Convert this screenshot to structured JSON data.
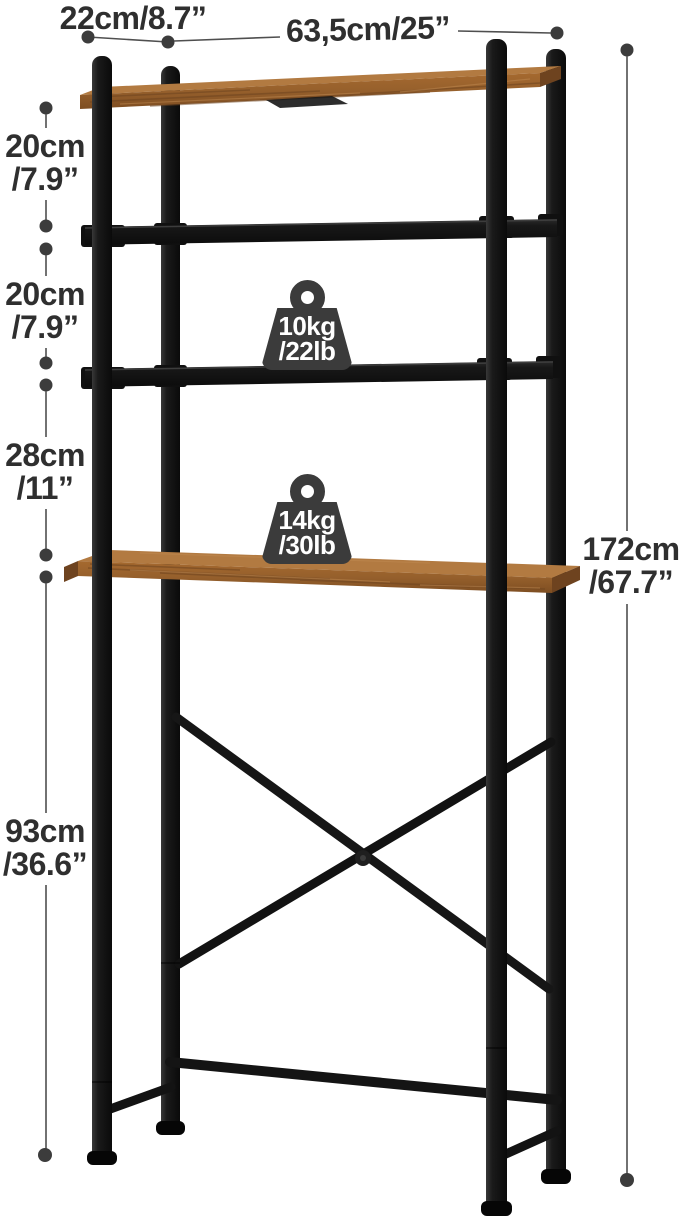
{
  "canvas": {
    "width": 679,
    "height": 1219,
    "background": "#ffffff"
  },
  "annotations": {
    "top_depth": {
      "text": "22cm/8.7”"
    },
    "top_width": {
      "text": "63,5cm/25”"
    },
    "left_chain": [
      {
        "cm": "20cm",
        "inch": "/7.9”"
      },
      {
        "cm": "20cm",
        "inch": "/7.9”"
      },
      {
        "cm": "28cm",
        "inch": "/11”"
      },
      {
        "cm": "93cm",
        "inch": "/36.6”"
      }
    ],
    "total_height": {
      "cm": "172cm",
      "inch": "/67.7”"
    }
  },
  "load_capacity": [
    {
      "icon": "weight-icon",
      "kg": "10kg",
      "lb": "/22lb"
    },
    {
      "icon": "weight-icon",
      "kg": "14kg",
      "lb": "/30lb"
    }
  ],
  "style": {
    "text_color": "#2f2f2f",
    "dimension_line_color": "#4f4f4f",
    "metal_color": "#151515",
    "wood_color": "#9c632f",
    "wood_top_color": "#b27a41",
    "badge_color": "#3b3b3b",
    "badge_text_color": "#ffffff"
  }
}
